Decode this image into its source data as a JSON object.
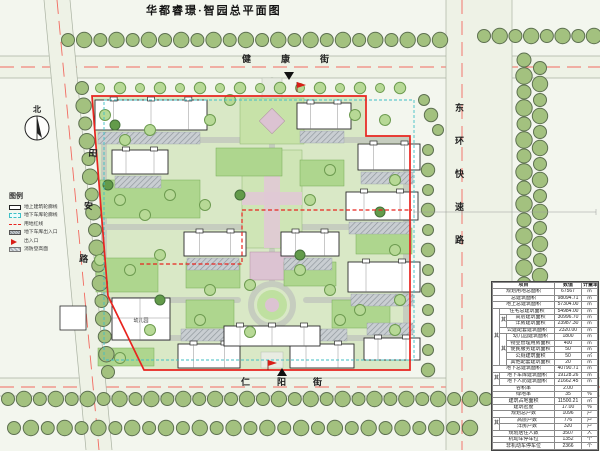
{
  "title": "华都睿璟·智园总平面图",
  "north_label": "北",
  "streets": {
    "north": "健康街",
    "south": "仁阳街",
    "west": "田安路",
    "east": "东环快速路"
  },
  "legend": {
    "title": "图例",
    "items": [
      {
        "label": "地上建筑轮廓线",
        "symbol": "building-outline"
      },
      {
        "label": "地下车库轮廓线",
        "symbol": "garage-outline"
      },
      {
        "label": "用地红线",
        "symbol": "red-line"
      },
      {
        "label": "地下车库出入口",
        "symbol": "garage-entry"
      },
      {
        "label": "出入口",
        "symbol": "entrance-flag"
      },
      {
        "label": "消防登高面",
        "symbol": "fire-surface"
      }
    ]
  },
  "plan_labels": {
    "kindergarten": "幼儿园"
  },
  "table": {
    "headers": {
      "item": "项目",
      "value": "数值",
      "unit": "计量单位"
    },
    "rows": [
      {
        "label": "规划用地总面积",
        "value": "67567",
        "unit": "㎡"
      },
      {
        "label": "总建筑面积",
        "value": "98094.71",
        "unit": "㎡"
      },
      {
        "label": "地上总建筑面积",
        "value": "57304.00",
        "unit": "㎡"
      },
      {
        "g1": "其中",
        "label": "住宅总建筑面积",
        "value": "54984.00",
        "unit": "㎡"
      },
      {
        "g1": "其中",
        "g2": "其中",
        "label": "高层建筑面积",
        "value": "30996.70",
        "unit": "㎡"
      },
      {
        "g1": "其中",
        "g2": "其中",
        "label": "洋房建筑面积",
        "value": "23987.30",
        "unit": "㎡"
      },
      {
        "g1": "其中",
        "label": "公建配套建筑面积",
        "value": "2320.00",
        "unit": "㎡"
      },
      {
        "g1": "其中",
        "g2": "其中",
        "label": "幼儿园建筑面积",
        "value": "1800",
        "unit": "㎡"
      },
      {
        "g1": "其中",
        "g2": "其中",
        "label": "物业管理用房面积",
        "value": "400",
        "unit": "㎡"
      },
      {
        "g1": "其中",
        "g2": "其中",
        "label": "便民服务建筑面积",
        "value": "50",
        "unit": "㎡"
      },
      {
        "g1": "其中",
        "g2": "其中",
        "label": "公厕建筑面积",
        "value": "50",
        "unit": "㎡"
      },
      {
        "g1": "其中",
        "g2": "其中",
        "label": "其他配套建筑面积",
        "value": "20",
        "unit": "㎡"
      },
      {
        "label": "地下总建筑面积",
        "value": "40790.71",
        "unit": "㎡"
      },
      {
        "g1": "其中",
        "label": "地下车库建筑面积",
        "value": "19128.26",
        "unit": "㎡"
      },
      {
        "g1": "其中",
        "label": "地下人防建筑面积",
        "value": "21662.45",
        "unit": "㎡"
      },
      {
        "label": "容积率",
        "value": "2.00",
        "unit": ""
      },
      {
        "label": "绿地率",
        "value": "35",
        "unit": "%"
      },
      {
        "label": "建筑占地面积",
        "value": "11500.21",
        "unit": "㎡"
      },
      {
        "label": "建筑密度",
        "value": "17.00",
        "unit": "%"
      },
      {
        "label": "规划总户数",
        "value": "1096",
        "unit": "户"
      },
      {
        "g1": "其中",
        "label": "高层户数",
        "value": "776",
        "unit": "户"
      },
      {
        "g1": "其中",
        "label": "洋房户数",
        "value": "320",
        "unit": "户"
      },
      {
        "label": "规划居住人数",
        "value": "3507",
        "unit": "人"
      },
      {
        "label": "机动车停车位",
        "value": "1352",
        "unit": "个"
      },
      {
        "label": "非机动车停车位",
        "value": "2366",
        "unit": "个"
      }
    ]
  },
  "colors": {
    "red_line": "#e8241f",
    "garage_dash": "#3fbfc6",
    "road_center": "#f26a60",
    "site_green": "#d9e8c6"
  }
}
